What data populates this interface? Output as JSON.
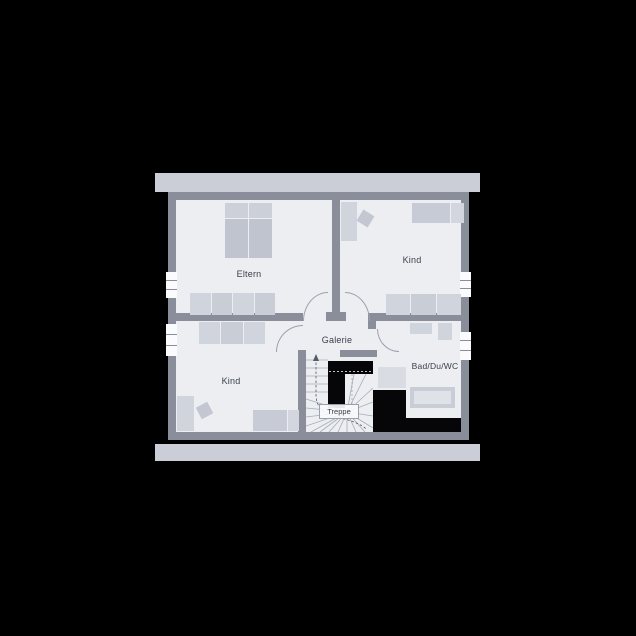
{
  "scene": {
    "type": "architectural-floor-plan",
    "floor_name": "upper-floor"
  },
  "colors": {
    "background": "#000000",
    "roof_bar": "#cbced6",
    "wall": "#8a8e9a",
    "floor": "#eceef2",
    "furniture": "#d0d4dc",
    "furniture_dark": "#c0c4cf",
    "black_mass": "#060608",
    "label_text": "#3b404a",
    "door_arc": "#9ba1ac"
  },
  "rooms": {
    "eltern": {
      "label": "Eltern"
    },
    "kind_top_right": {
      "label": "Kind"
    },
    "kind_bottom_left": {
      "label": "Kind"
    },
    "galerie": {
      "label": "Galerie"
    },
    "treppe": {
      "label": "Treppe"
    },
    "bad_du_wc": {
      "label": "Bad/Du/WC"
    }
  },
  "furniture": {
    "eltern": [
      "double-bed",
      "wardrobe-row"
    ],
    "kind_top_right": [
      "desk",
      "chair",
      "single-bed",
      "wardrobe-row"
    ],
    "kind_bottom_left": [
      "wardrobe-row",
      "desk",
      "chair",
      "single-bed"
    ],
    "bad_du_wc": [
      "washbasin",
      "wc",
      "shower",
      "bathtub"
    ],
    "treppe": [
      "winder-staircase",
      "up-arrow"
    ]
  },
  "windows": {
    "left_wall": 2,
    "right_wall": 2
  }
}
